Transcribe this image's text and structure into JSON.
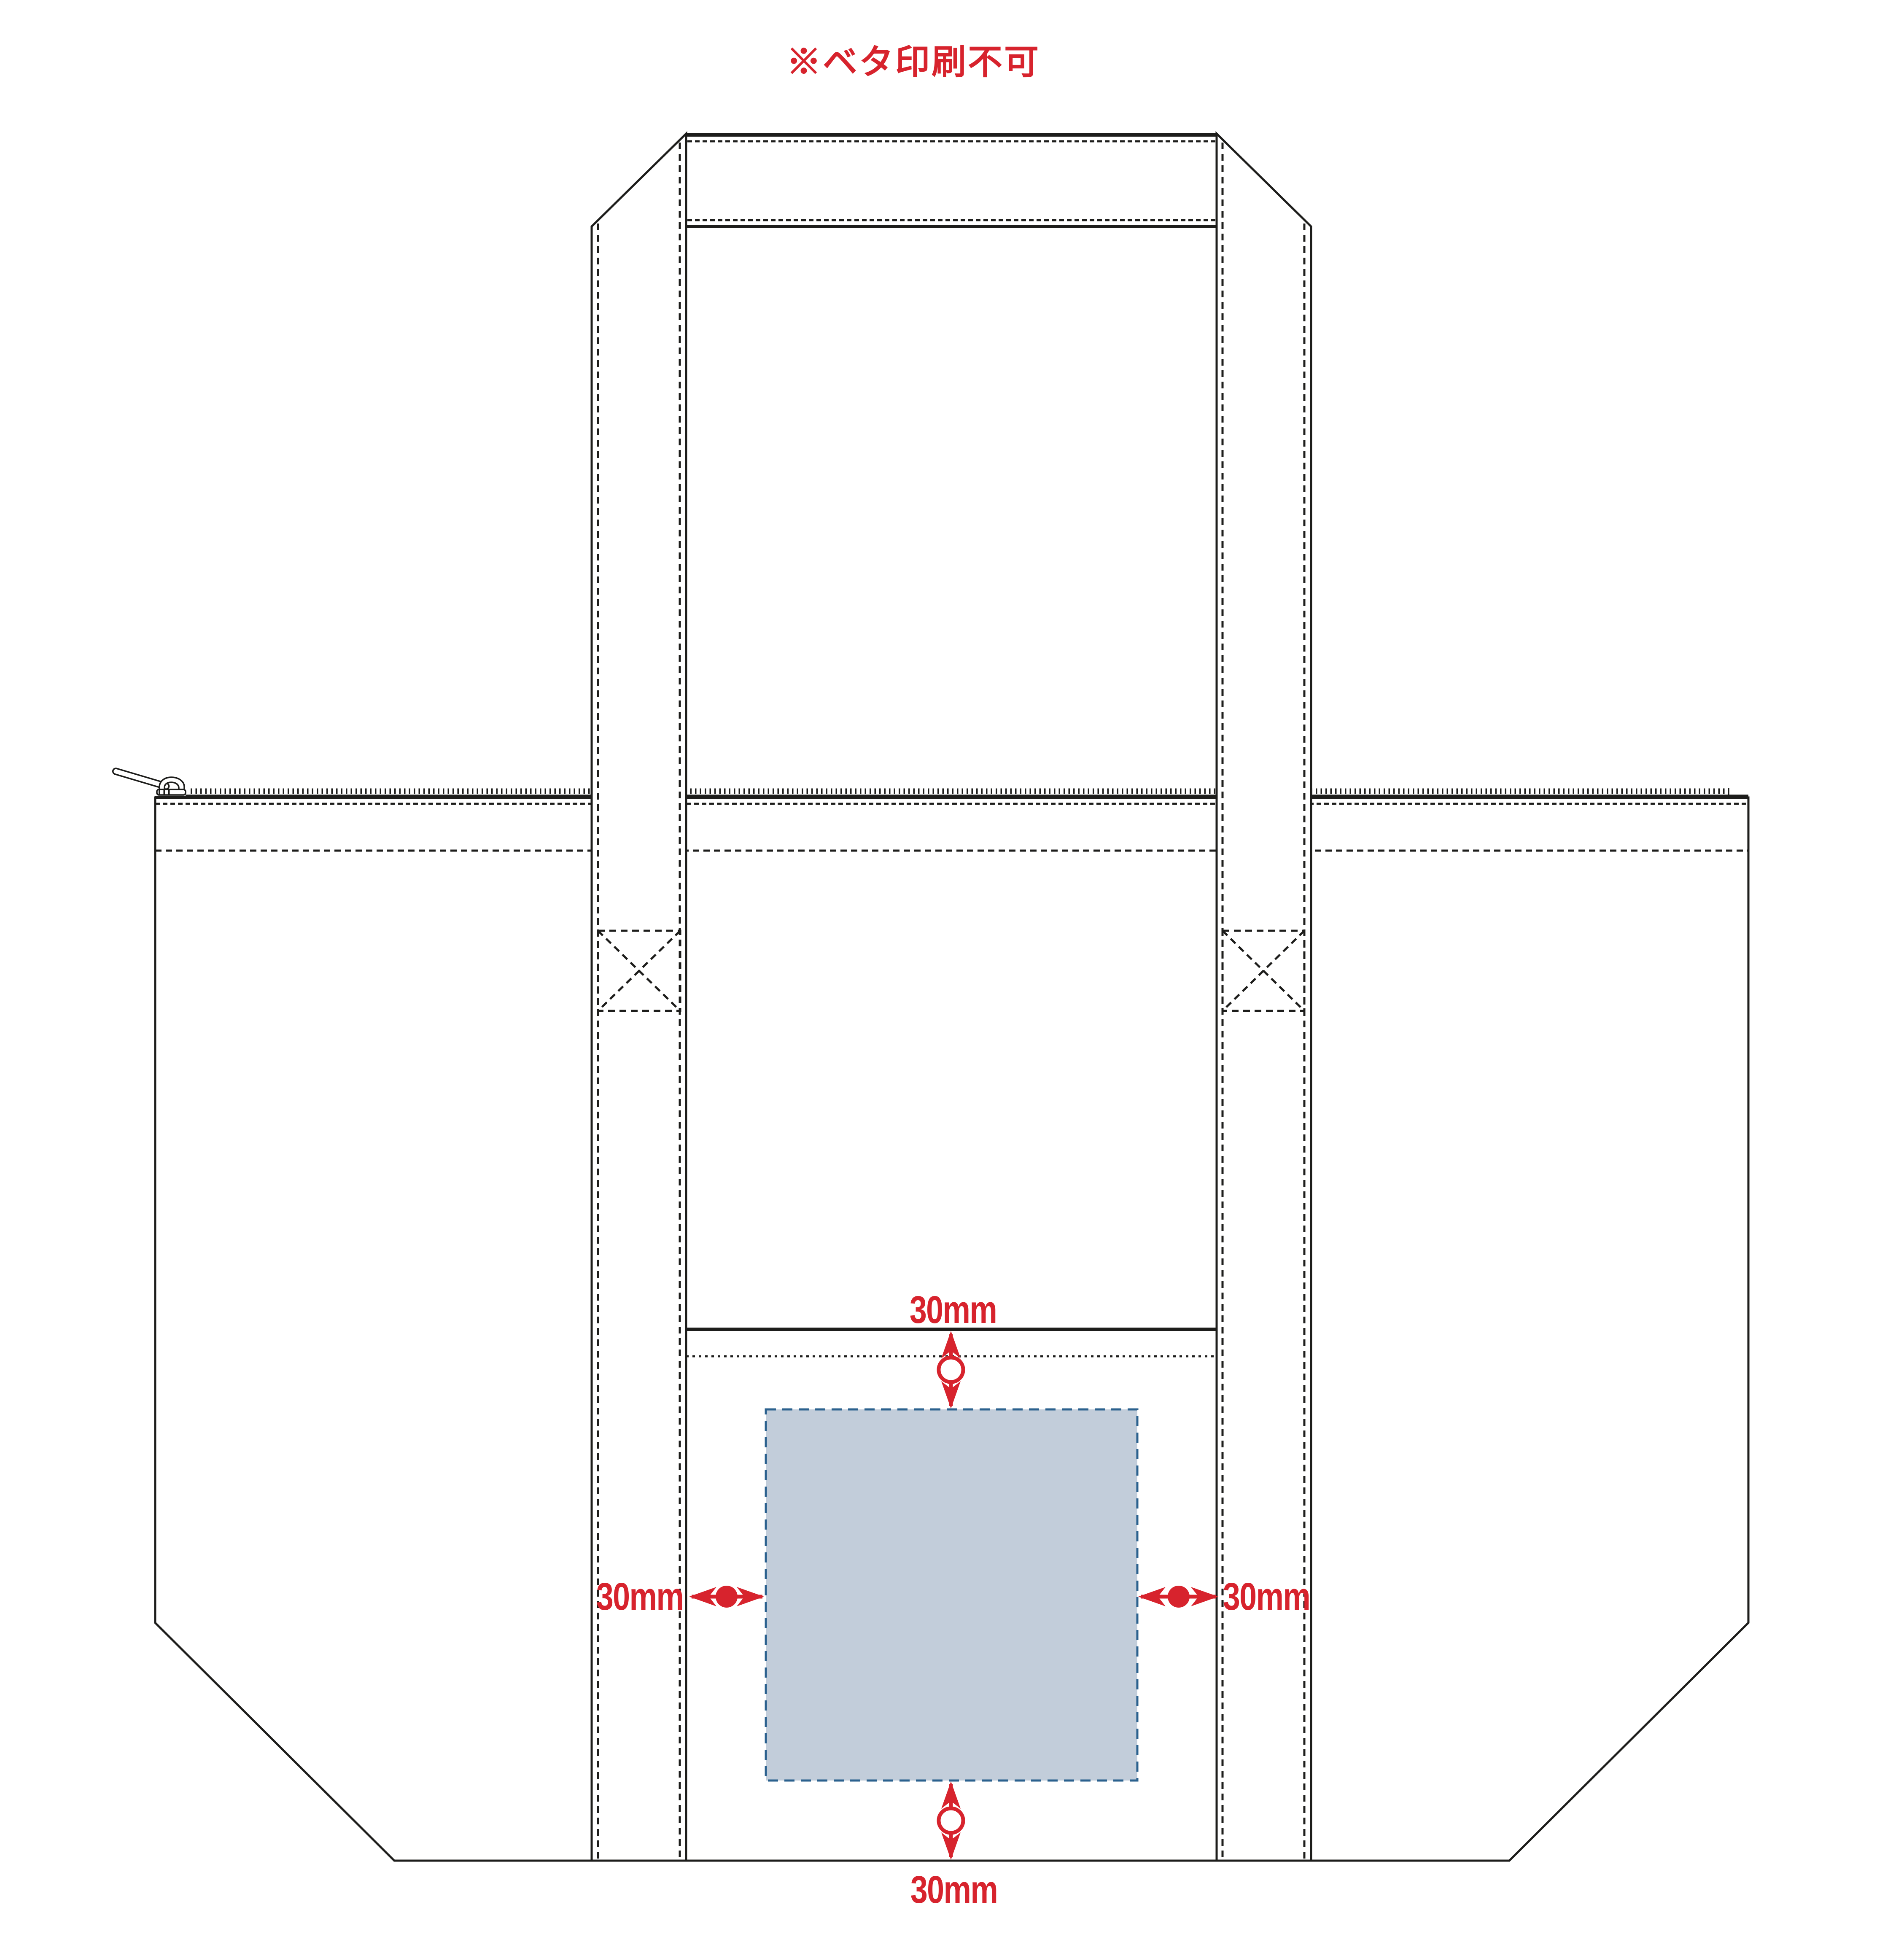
{
  "title": "※ベタ印刷不可",
  "annotations": {
    "top": {
      "side": "top",
      "label": "30mm"
    },
    "left": {
      "side": "left",
      "label": "30mm"
    },
    "right": {
      "side": "right",
      "label": "30mm"
    },
    "bottom": {
      "side": "bottom",
      "label": "30mm"
    }
  },
  "colors": {
    "background": "#ffffff",
    "line_black": "#1d1d1b",
    "annotation_red": "#d7232d",
    "print_area_fill": "#c2cdda",
    "print_area_border": "#2b618e"
  }
}
